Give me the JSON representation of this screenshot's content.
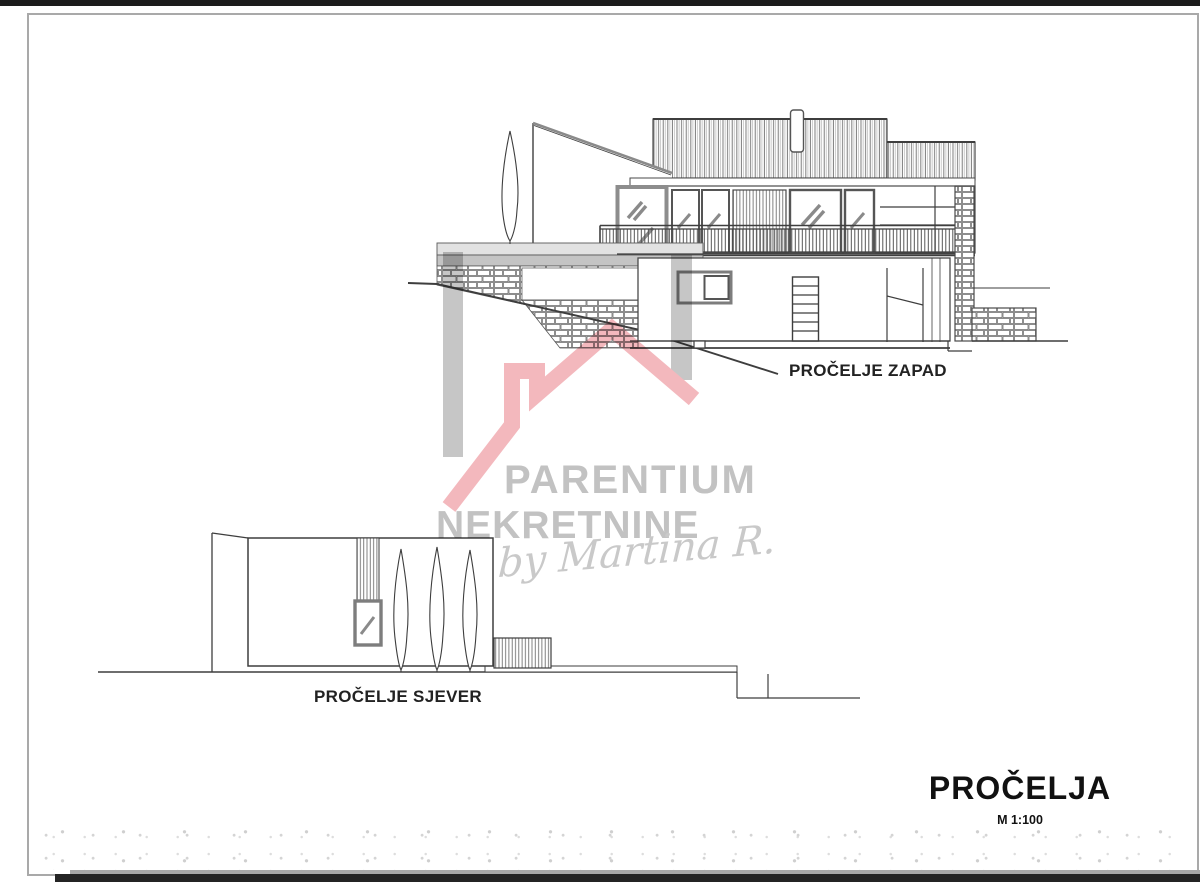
{
  "drawing": {
    "sheet_title": "PROČELJA",
    "scale": "M 1:100",
    "elevations": [
      {
        "id": "west",
        "label": "PROČELJE ZAPAD"
      },
      {
        "id": "north",
        "label": "PROČELJE SJEVER"
      }
    ]
  },
  "watermark": {
    "brand_line1": "PARENTIUM",
    "brand_line2": "NEKRETNINE",
    "byline": "by Martina R.",
    "colors": {
      "roof_pink": "#f3b8bd",
      "wall_gray": "#c6c6c6",
      "text_gray": "#c2c2c2"
    }
  },
  "style": {
    "line_color": "#3e3e3e",
    "frame_color": "#a9a9a9",
    "paper": "#ffffff",
    "scan_bar": "#1c1c1c",
    "slab_gray_light": "#e2e2e2",
    "slab_gray_dark": "#c4c4c4"
  }
}
